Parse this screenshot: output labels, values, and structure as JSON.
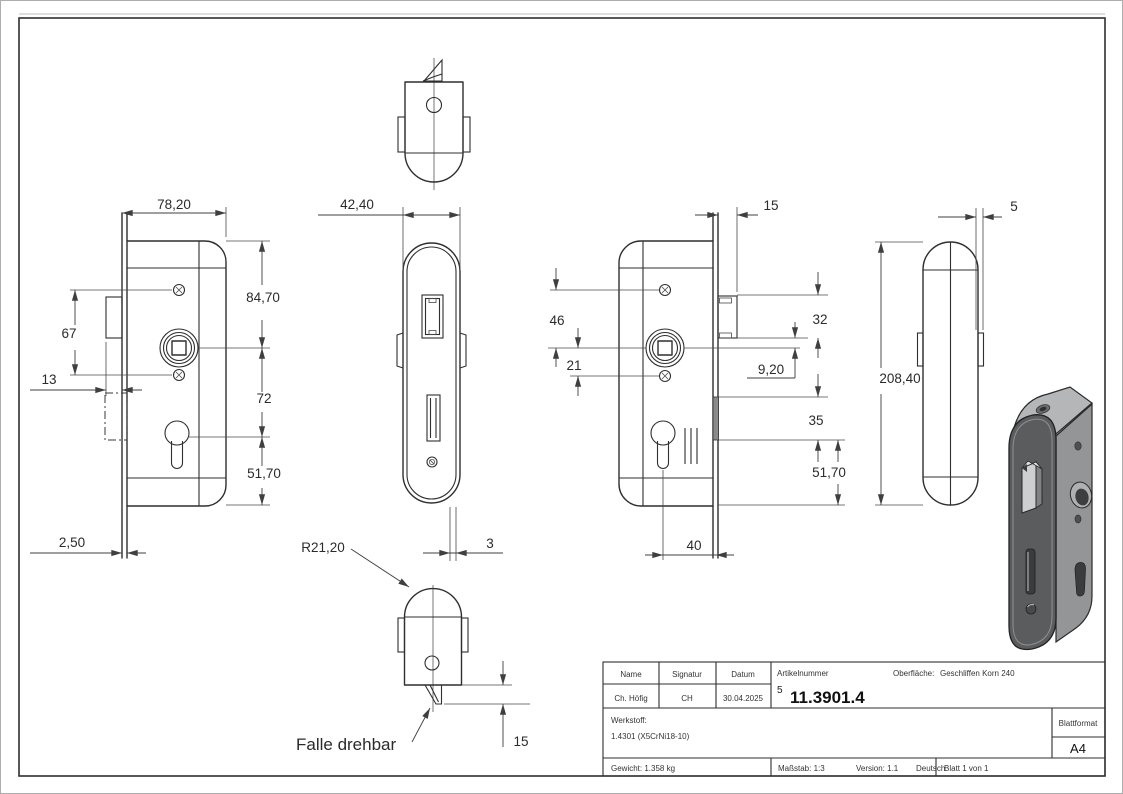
{
  "sheet": {
    "dimensions": {
      "v1_width": "78,20",
      "v1_screws": "67",
      "v1_latch_offset": "13",
      "v1_top_spindle": "84,70",
      "v1_spindle_cyl": "72",
      "v1_cyl_bottom": "51,70",
      "v1_faceplate_t": "2,50",
      "v2_width": "42,40",
      "v2_radius": "R21,20",
      "v2_edge": "3",
      "v2_latch_proj": "15",
      "v3_latch_proj": "15",
      "v3_spindle_screw1": "46",
      "v3_spindle_screw2": "21",
      "v3_latch_h": "32",
      "v3_latch_spindle": "9,20",
      "v3_bolt_h": "35",
      "v3_bolt_bottom": "51,70",
      "v3_backset": "40",
      "v5_plate": "5",
      "v5_height": "208,40"
    },
    "labels": {
      "latch_note": "Falle drehbar"
    },
    "title_block": {
      "headers": {
        "name": "Name",
        "signatur": "Signatur",
        "datum": "Datum",
        "artikelnummer": "Artikelnummer",
        "oberflaeche": "Oberfläche:",
        "blattformat": "Blattformat"
      },
      "values": {
        "name": "Ch. Höfig",
        "signatur": "CH",
        "datum": "30.04.2025",
        "artikelnummer_prefix": "5",
        "artikelnummer": "11.3901.4",
        "oberflaeche": "Geschliffen Korn 240",
        "werkstoff_label": "Werkstoff:",
        "werkstoff": "1.4301 (X5CrNi18-10)",
        "blattformat": "A4",
        "gewicht": "Gewicht: 1.358 kg",
        "massstab": "Maßstab: 1:3",
        "version": "Version: 1.1",
        "sprache": "Deutsch",
        "blatt": "Blatt 1 von 1"
      }
    },
    "colors": {
      "line": "#2f2f2f",
      "dim": "#3f3f3f",
      "bolt_fill": "#8a8a8a",
      "render_front": "#5a5c5e",
      "render_side": "#939597",
      "render_top": "#b4b6b8"
    }
  }
}
